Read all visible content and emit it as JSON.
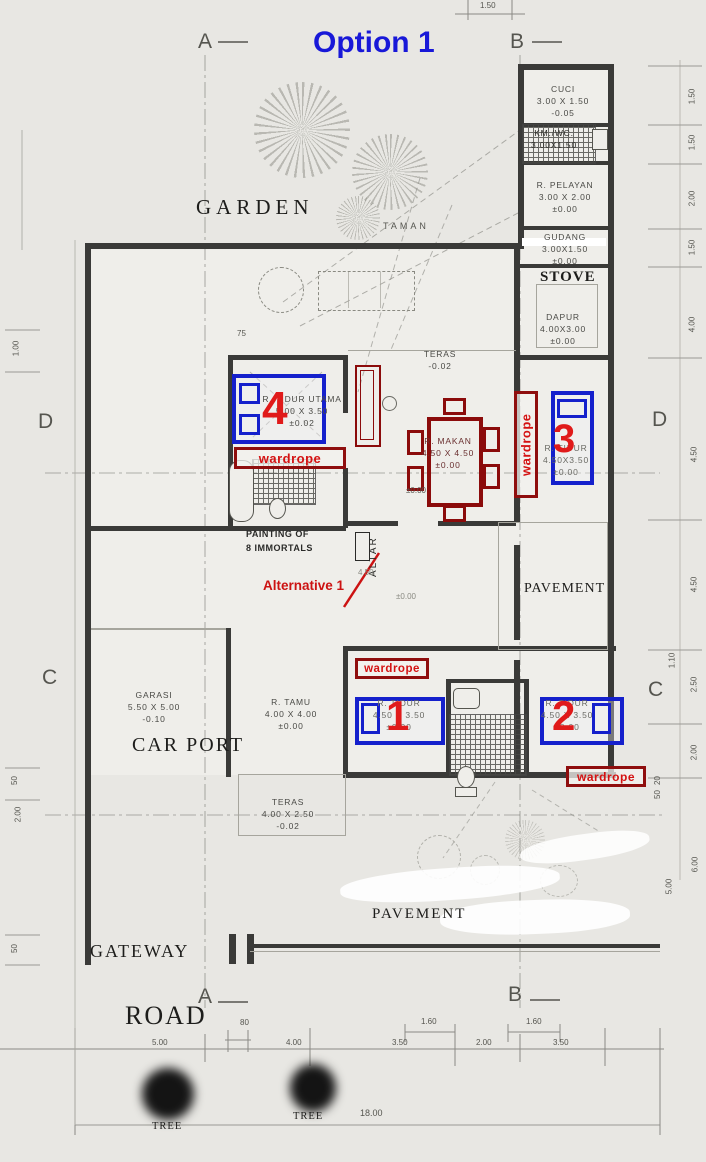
{
  "title": "Option 1",
  "grid": {
    "a": "A",
    "b": "B",
    "c": "C",
    "d": "D"
  },
  "rooms": {
    "cuci": {
      "name": "CUCI",
      "dims": "3.00 X 1.50",
      "level": "-0.05"
    },
    "kmwc_annex": {
      "name": "KM./WC.",
      "dims": "3.00X1.50",
      "level": "-0.05"
    },
    "pelayan": {
      "name": "R. PELAYAN",
      "dims": "3.00 X 2.00",
      "level": "±0.00"
    },
    "gudang": {
      "name": "GUDANG",
      "dims": "3.00X1.50",
      "level": "±0.00"
    },
    "dapur": {
      "name": "DAPUR",
      "dims": "4.00X3.00",
      "level": "±0.00"
    },
    "tidur_utama": {
      "name": "R. TIDUR UTAMA",
      "dims": "5.00 X 3.50",
      "level": "±0.02"
    },
    "makan": {
      "name": "R. MAKAN",
      "dims": "4.50 X 4.50",
      "level": "±0.00"
    },
    "tidur3": {
      "name": "R. TIDUR",
      "dims": "4.50X3.50",
      "level": "±0.00"
    },
    "garasi": {
      "name": "GARASI",
      "dims": "5.50 X 5.00",
      "level": "-0.10"
    },
    "tamu": {
      "name": "R. TAMU",
      "dims": "4.00 X 4.00",
      "level": "±0.00"
    },
    "tidur1": {
      "name": "R. TIDUR",
      "dims": "4.50 X 3.50",
      "level": "±0.00"
    },
    "tidur2": {
      "name": "R. TIDUR",
      "dims": "4.50 X 3.50",
      "level": "±0.00"
    },
    "teras_top": {
      "name": "TERAS",
      "level": "-0.02"
    },
    "teras_bottom": {
      "name": "TERAS",
      "dims": "4.00 X 2.50",
      "level": "-0.02"
    }
  },
  "areas": {
    "garden": "GARDEN",
    "taman": "TAMAN",
    "stove": "STOVE",
    "car_port": "CAR PORT",
    "pavement_mid": "PAVEMENT",
    "pavement_bottom": "PAVEMENT",
    "gateway": "GATEWAY",
    "road": "ROAD",
    "tree1": "TREE",
    "tree2": "TREE"
  },
  "annotations": {
    "wardrobe1": "wardrope",
    "wardrobe2": "wardrope",
    "wardrobe3": "wardrope",
    "wardrobe4": "wardrope",
    "num1": "1",
    "num2": "2",
    "num3": "3",
    "num4": "4",
    "alternative": "Alternative 1",
    "altar": "ALTAR",
    "painting_line1": "PAINTING OF",
    "painting_line2": "8 IMMORTALS",
    "frag_dim": "4.50",
    "frag_level": "±0.00",
    "frag_level_foyer": "±0.00"
  },
  "dimensions": {
    "top": "1.50",
    "right": [
      "1.50",
      "1.50",
      "2.00",
      "1.50",
      "4.00",
      "4.50",
      "4.50",
      "1.10",
      "2.50",
      "2.00",
      "20",
      "50",
      "5.00",
      "6.00"
    ],
    "left": [
      "1.00",
      "50",
      "2.00",
      "50"
    ],
    "bottom_upper": [
      "80",
      "1.60",
      "1.60"
    ],
    "bottom": [
      "5.00",
      "4.00",
      "3.50",
      "2.00",
      "3.50"
    ],
    "total": "18.00",
    "misc": "75"
  },
  "colors": {
    "accent_blue": "#1818d8",
    "annotation_red": "#e01a1a",
    "dark_red": "#8b0b0b",
    "wall": "#3a3a38"
  }
}
